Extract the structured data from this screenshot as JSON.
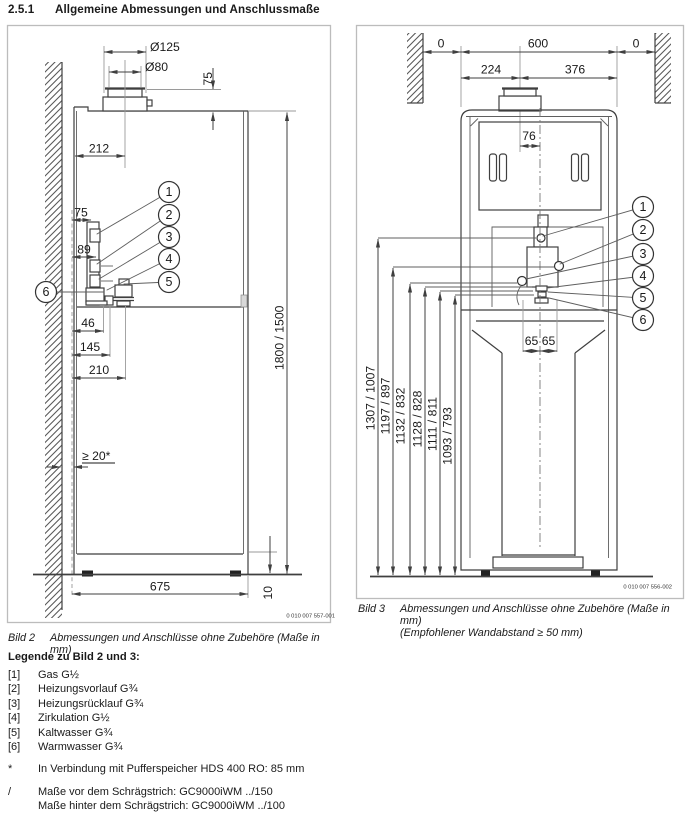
{
  "page": {
    "heading_number": "2.5.1",
    "heading_title": "Allgemeine Abmessungen und Anschlussmaße"
  },
  "bild2": {
    "label": "Bild 2",
    "caption": "Abmessungen und Anschlüsse ohne Zubehöre (Maße in mm)",
    "code": "0 010 007 557-001",
    "dims": {
      "flue_outer_dia": "Ø125",
      "flue_inner_dia": "Ø80",
      "flue_height": "75",
      "flue_offset": "212",
      "gas_offset": "75",
      "conn_offset": "89",
      "d46": "46",
      "d145": "145",
      "d210": "210",
      "height": "1800 / 1500",
      "wall_gap": "≥ 20*",
      "width": "675",
      "feet_height": "10"
    },
    "callouts": [
      "1",
      "2",
      "3",
      "4",
      "5",
      "6"
    ]
  },
  "bild3": {
    "label": "Bild 3",
    "caption_line1": "Abmessungen und Anschlüsse ohne Zubehöre (Maße in mm)",
    "caption_line2": "(Empfohlener Wandabstand ≥ 50 mm)",
    "code": "0 010 007 556-002",
    "dims": {
      "left_gap": "0",
      "width": "600",
      "right_gap": "0",
      "left_to_flue": "224",
      "flue_to_right": "376",
      "flue_center_offset": "76",
      "left65": "65",
      "right65": "65",
      "heights": [
        "1307 / 1007",
        "1197 / 897",
        "1132 / 832",
        "1128 / 828",
        "1111 / 811",
        "1093 / 793"
      ]
    },
    "callouts": [
      "1",
      "2",
      "3",
      "4",
      "5",
      "6"
    ]
  },
  "legend": {
    "title": "Legende zu Bild 2 und 3:",
    "items": [
      {
        "key": "[1]",
        "text": "Gas G½"
      },
      {
        "key": "[2]",
        "text": "Heizungsvorlauf G¾"
      },
      {
        "key": "[3]",
        "text": "Heizungsrücklauf G¾"
      },
      {
        "key": "[4]",
        "text": "Zirkulation G½"
      },
      {
        "key": "[5]",
        "text": "Kaltwasser G¾"
      },
      {
        "key": "[6]",
        "text": "Warmwasser G¾"
      },
      {
        "key": "*",
        "text": "In Verbindung mit Pufferspeicher HDS 400 RO: 85 mm"
      },
      {
        "key": "/",
        "text": "Maße vor dem Schrägstrich: GC9000iWM ../150",
        "text2": "Maße hinter dem Schrägstrich: GC9000iWM ../100"
      }
    ]
  }
}
